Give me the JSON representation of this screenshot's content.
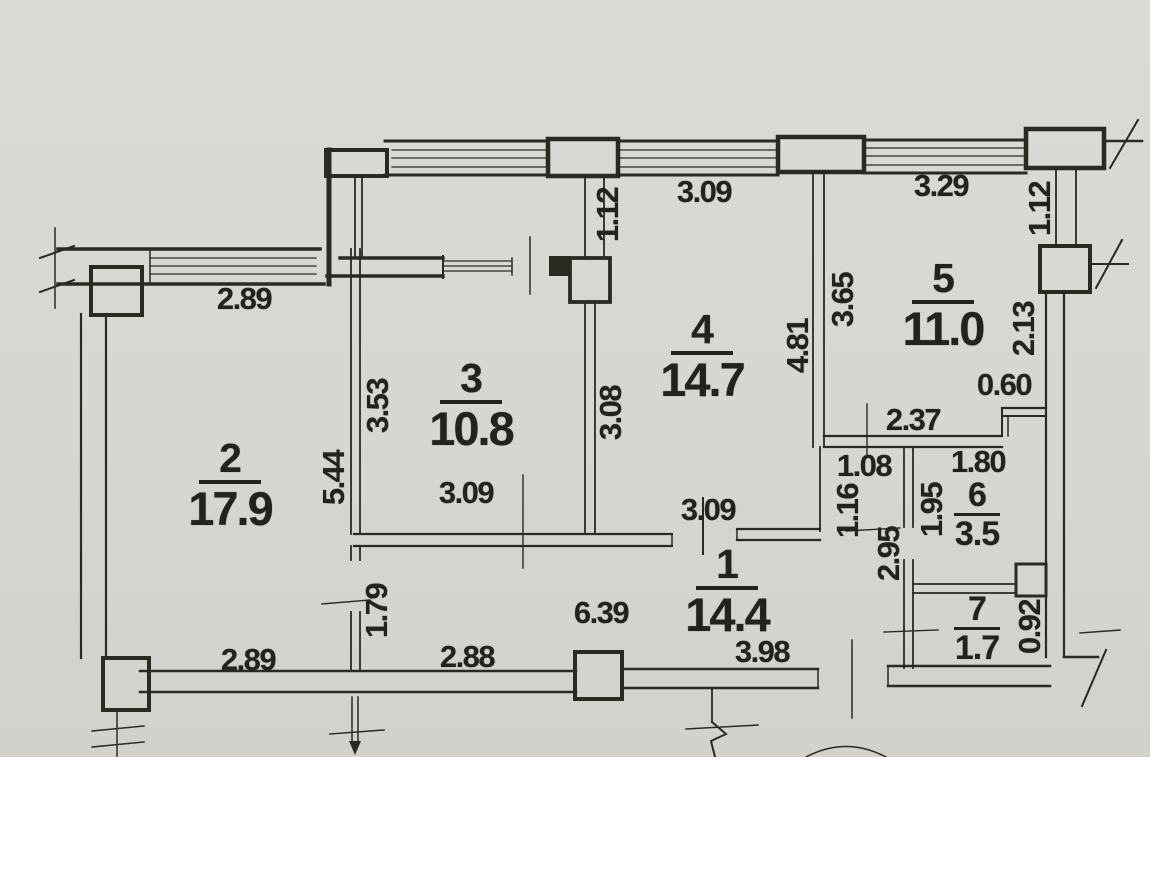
{
  "plan": {
    "drawing_type": "apartment-floor-plan",
    "rooms": [
      {
        "number": "1",
        "area": "14.4",
        "x": 727,
        "y": 544,
        "size": "large"
      },
      {
        "number": "2",
        "area": "17.9",
        "x": 230,
        "y": 438,
        "size": "large"
      },
      {
        "number": "3",
        "area": "10.8",
        "x": 471,
        "y": 358,
        "size": "large"
      },
      {
        "number": "4",
        "area": "14.7",
        "x": 702,
        "y": 309,
        "size": "large"
      },
      {
        "number": "5",
        "area": "11.0",
        "x": 943,
        "y": 258,
        "size": "large"
      },
      {
        "number": "6",
        "area": "3.5",
        "x": 977,
        "y": 478,
        "size": "small"
      },
      {
        "number": "7",
        "area": "1.7",
        "x": 977,
        "y": 592,
        "size": "small"
      }
    ],
    "dimensions": [
      {
        "text": "2.89",
        "x": 244,
        "y": 299,
        "rotated": false
      },
      {
        "text": "1.12",
        "x": 608,
        "y": 215,
        "rotated": true
      },
      {
        "text": "3.09",
        "x": 704,
        "y": 192,
        "rotated": false
      },
      {
        "text": "3.29",
        "x": 941,
        "y": 186,
        "rotated": false
      },
      {
        "text": "1.12",
        "x": 1040,
        "y": 209,
        "rotated": true
      },
      {
        "text": "2.13",
        "x": 1024,
        "y": 329,
        "rotated": true
      },
      {
        "text": "3.65",
        "x": 843,
        "y": 300,
        "rotated": true
      },
      {
        "text": "4.81",
        "x": 798,
        "y": 346,
        "rotated": true
      },
      {
        "text": "0.60",
        "x": 1004,
        "y": 385,
        "rotated": false
      },
      {
        "text": "2.37",
        "x": 913,
        "y": 420,
        "rotated": false
      },
      {
        "text": "1.80",
        "x": 978,
        "y": 462,
        "rotated": false
      },
      {
        "text": "1.08",
        "x": 864,
        "y": 466,
        "rotated": false
      },
      {
        "text": "1.16",
        "x": 848,
        "y": 511,
        "rotated": true
      },
      {
        "text": "1.95",
        "x": 932,
        "y": 510,
        "rotated": true
      },
      {
        "text": "2.95",
        "x": 889,
        "y": 554,
        "rotated": true
      },
      {
        "text": "3.53",
        "x": 378,
        "y": 406,
        "rotated": true
      },
      {
        "text": "5.44",
        "x": 334,
        "y": 478,
        "rotated": true
      },
      {
        "text": "3.08",
        "x": 611,
        "y": 413,
        "rotated": true
      },
      {
        "text": "3.09",
        "x": 466,
        "y": 493,
        "rotated": false
      },
      {
        "text": "3.09",
        "x": 708,
        "y": 510,
        "rotated": false
      },
      {
        "text": "6.39",
        "x": 601,
        "y": 613,
        "rotated": false
      },
      {
        "text": "1.79",
        "x": 377,
        "y": 611,
        "rotated": true
      },
      {
        "text": "2.89",
        "x": 248,
        "y": 660,
        "rotated": false
      },
      {
        "text": "2.88",
        "x": 467,
        "y": 657,
        "rotated": false
      },
      {
        "text": "3.98",
        "x": 762,
        "y": 652,
        "rotated": false
      },
      {
        "text": "0.92",
        "x": 1030,
        "y": 627,
        "rotated": true
      }
    ]
  }
}
